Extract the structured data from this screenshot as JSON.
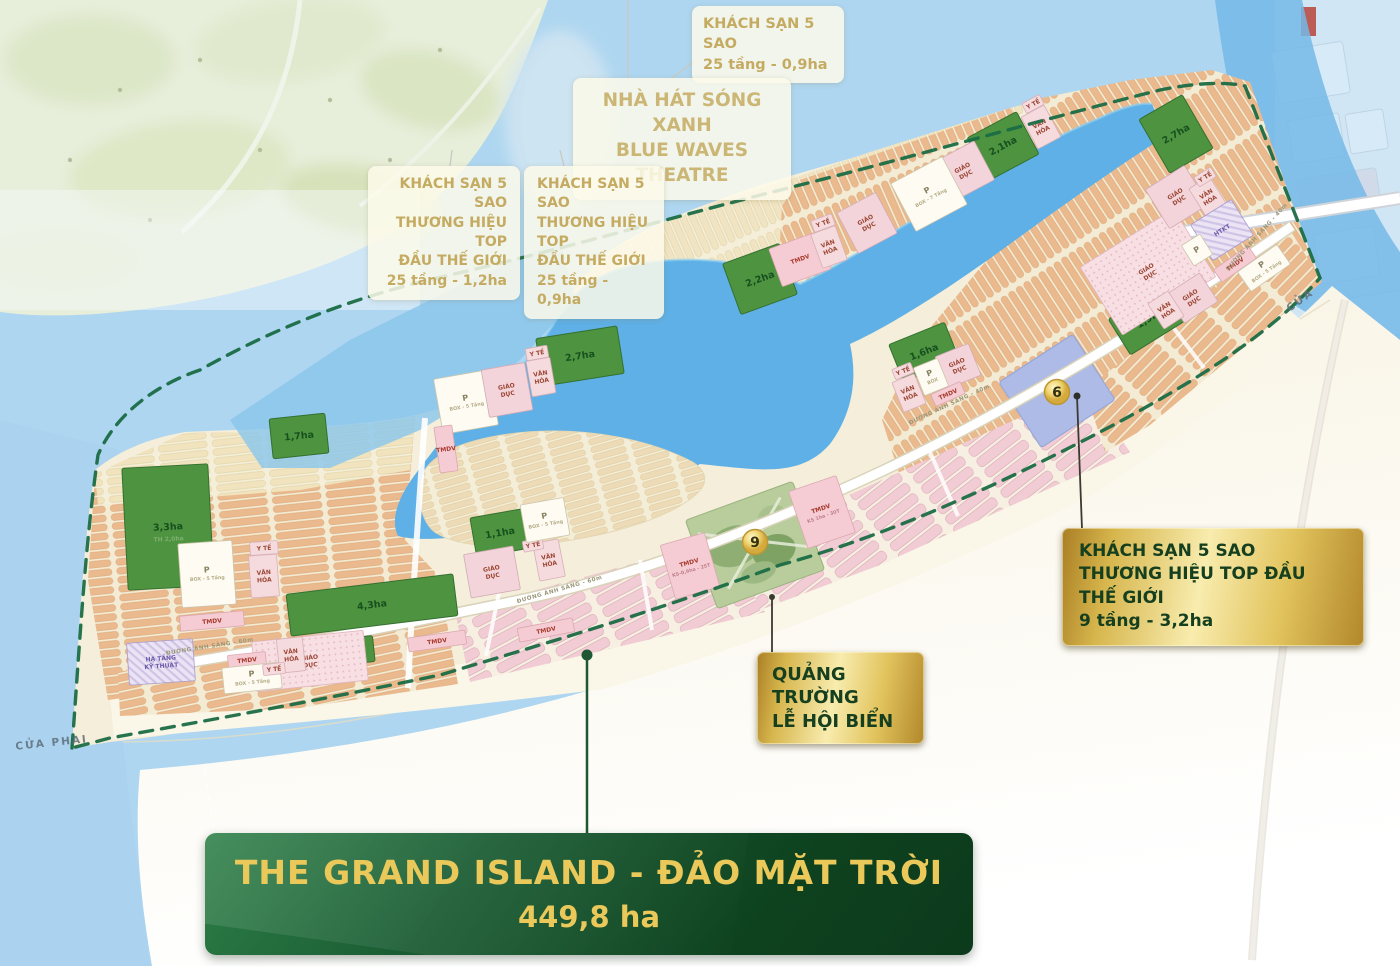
{
  "island": {
    "name_line1": "THE GRAND ISLAND - ĐẢO MẶT TRỜI",
    "area": "449,8 ha"
  },
  "callouts": {
    "hotel_top": {
      "lines": [
        "KHÁCH SẠN 5 SAO",
        "25 tầng - 0,9ha"
      ]
    },
    "theatre": {
      "lines": [
        "NHÀ HÁT SÓNG XANH",
        "BLUE WAVES THEATRE"
      ]
    },
    "hotel_left1": {
      "lines": [
        "KHÁCH SẠN 5 SAO",
        "THƯƠNG HIỆU TOP",
        "ĐẦU THẾ GIỚI",
        "25 tầng - 1,2ha"
      ]
    },
    "hotel_left2": {
      "lines": [
        "KHÁCH SẠN 5 SAO",
        "THƯƠNG HIỆU TOP",
        "ĐẦU THẾ GIỚI",
        "25 tầng - 0,9ha"
      ]
    },
    "hotel_right": {
      "lines": [
        "KHÁCH SẠN 5 SAO",
        "THƯƠNG HIỆU TOP ĐẦU THẾ GIỚI",
        "9 tầng - 3,2ha"
      ]
    },
    "plaza": {
      "lines": [
        "QUẢNG TRƯỜNG",
        "LỄ HỘI BIỂN"
      ]
    }
  },
  "map": {
    "parks": [
      {
        "t": "3,3ha",
        "sub": "TH 2,0ha",
        "x": 168,
        "y": 527,
        "w": 86,
        "h": 122,
        "r": -3
      },
      {
        "t": "1,7ha",
        "x": 299,
        "y": 436,
        "w": 56,
        "h": 40,
        "r": -6
      },
      {
        "t": "2,7ha",
        "x": 580,
        "y": 356,
        "w": 82,
        "h": 48,
        "r": -9
      },
      {
        "t": "2,2ha",
        "x": 760,
        "y": 279,
        "w": 60,
        "h": 54,
        "r": -20
      },
      {
        "t": "2,1ha",
        "x": 1003,
        "y": 146,
        "w": 56,
        "h": 48,
        "r": -28
      },
      {
        "t": "2,7ha",
        "x": 1176,
        "y": 134,
        "w": 50,
        "h": 62,
        "r": -30
      },
      {
        "t": "1,6ha",
        "x": 924,
        "y": 352,
        "w": 60,
        "h": 40,
        "r": -22
      },
      {
        "t": "1,9ha",
        "x": 1150,
        "y": 318,
        "w": 72,
        "h": 42,
        "r": -32
      },
      {
        "t": "1,1ha",
        "x": 500,
        "y": 533,
        "w": 54,
        "h": 40,
        "r": -10
      },
      {
        "t": "4,3ha",
        "x": 372,
        "y": 605,
        "w": 168,
        "h": 42,
        "r": -7
      },
      {
        "t": "1,3ha",
        "x": 331,
        "y": 653,
        "w": 86,
        "h": 26,
        "r": -6
      }
    ],
    "facilities": [
      {
        "l": [
          "P",
          "BOX - 5 Tầng"
        ],
        "t": "parking",
        "x": 207,
        "y": 574,
        "w": 54,
        "h": 64,
        "r": -4
      },
      {
        "l": [
          "VĂN",
          "HÓA"
        ],
        "t": "culture",
        "x": 264,
        "y": 576,
        "w": 28,
        "h": 42,
        "r": -4
      },
      {
        "l": [
          "Y TẾ"
        ],
        "t": "health",
        "x": 264,
        "y": 548,
        "w": 28,
        "h": 13,
        "r": -4
      },
      {
        "l": [
          "TMDV"
        ],
        "t": "tmdv",
        "x": 212,
        "y": 621,
        "w": 64,
        "h": 15,
        "r": -5
      },
      {
        "l": [
          "HẠ TẦNG",
          "KỸ THUẬT"
        ],
        "t": "htkt",
        "x": 161,
        "y": 662,
        "w": 66,
        "h": 42,
        "r": -4
      },
      {
        "l": [
          "GIÁO",
          "DỤC"
        ],
        "t": "zone",
        "x": 310,
        "y": 661,
        "w": 112,
        "h": 50,
        "r": -6
      },
      {
        "l": [
          "TMDV"
        ],
        "t": "tmdv",
        "x": 247,
        "y": 660,
        "w": 38,
        "h": 13,
        "r": -6
      },
      {
        "l": [
          "P",
          "BOX - 5 Tầng"
        ],
        "t": "parking",
        "x": 252,
        "y": 678,
        "w": 58,
        "h": 26,
        "r": -6
      },
      {
        "l": [
          "VĂN",
          "HÓA"
        ],
        "t": "culture",
        "x": 291,
        "y": 655,
        "w": 26,
        "h": 34,
        "r": -6
      },
      {
        "l": [
          "Y TẾ"
        ],
        "t": "health",
        "x": 274,
        "y": 669,
        "w": 22,
        "h": 11,
        "r": -6
      },
      {
        "l": [
          "TMDV"
        ],
        "t": "tmdv",
        "x": 437,
        "y": 641,
        "w": 58,
        "h": 14,
        "r": -8
      },
      {
        "l": [
          "GIÁO",
          "DỤC"
        ],
        "t": "edu",
        "x": 492,
        "y": 572,
        "w": 50,
        "h": 44,
        "r": -10
      },
      {
        "l": [
          "VĂN",
          "HÓA"
        ],
        "t": "culture",
        "x": 549,
        "y": 560,
        "w": 26,
        "h": 38,
        "r": -11
      },
      {
        "l": [
          "Y TẾ"
        ],
        "t": "health",
        "x": 533,
        "y": 545,
        "w": 20,
        "h": 11,
        "r": -11
      },
      {
        "l": [
          "TMDV"
        ],
        "t": "tmdv",
        "x": 546,
        "y": 630,
        "w": 56,
        "h": 14,
        "r": -11
      },
      {
        "l": [
          "P",
          "BOX - 5 Tầng"
        ],
        "t": "parking",
        "x": 466,
        "y": 402,
        "w": 56,
        "h": 56,
        "r": -10
      },
      {
        "l": [
          "GIÁO",
          "DỤC"
        ],
        "t": "edu",
        "x": 507,
        "y": 390,
        "w": 44,
        "h": 48,
        "r": -10
      },
      {
        "l": [
          "VĂN",
          "HÓA"
        ],
        "t": "culture",
        "x": 541,
        "y": 377,
        "w": 24,
        "h": 36,
        "r": -10
      },
      {
        "l": [
          "Y TẾ"
        ],
        "t": "health",
        "x": 537,
        "y": 353,
        "w": 22,
        "h": 12,
        "r": -10
      },
      {
        "l": [
          "TMDV"
        ],
        "t": "tmdv",
        "x": 446,
        "y": 449,
        "w": 18,
        "h": 46,
        "r": -8
      },
      {
        "l": [
          "P",
          "BOX - 5 Tầng"
        ],
        "t": "parking",
        "x": 545,
        "y": 520,
        "w": 44,
        "h": 38,
        "r": -10
      },
      {
        "l": [
          "TMDV"
        ],
        "t": "tmdv",
        "x": 800,
        "y": 259,
        "w": 52,
        "h": 40,
        "r": -20
      },
      {
        "l": [
          "VĂN",
          "HÓA"
        ],
        "t": "culture",
        "x": 829,
        "y": 247,
        "w": 26,
        "h": 36,
        "r": -20
      },
      {
        "l": [
          "Y TẾ"
        ],
        "t": "health",
        "x": 823,
        "y": 223,
        "w": 22,
        "h": 12,
        "r": -20
      },
      {
        "l": [
          "GIÁO",
          "DỤC"
        ],
        "t": "edu",
        "x": 958,
        "y": 366,
        "w": 36,
        "h": 34,
        "r": -22
      },
      {
        "l": [
          "P",
          "BOX"
        ],
        "t": "parking",
        "x": 931,
        "y": 377,
        "w": 26,
        "h": 30,
        "r": -22
      },
      {
        "l": [
          "VĂN",
          "HÓA"
        ],
        "t": "culture",
        "x": 909,
        "y": 393,
        "w": 24,
        "h": 32,
        "r": -22
      },
      {
        "l": [
          "Y TẾ"
        ],
        "t": "health",
        "x": 903,
        "y": 371,
        "w": 20,
        "h": 11,
        "r": -22
      },
      {
        "l": [
          "TMDV"
        ],
        "t": "tmdv",
        "x": 948,
        "y": 394,
        "w": 32,
        "h": 13,
        "r": -24
      },
      {
        "l": [
          "TMDV",
          "KS-0,9ha - 25T"
        ],
        "t": "ks",
        "x": 690,
        "y": 566,
        "w": 46,
        "h": 56,
        "r": -16
      },
      {
        "l": [
          "TMDV",
          "KS 1ha - 30T"
        ],
        "t": "ks",
        "x": 822,
        "y": 512,
        "w": 50,
        "h": 60,
        "r": -19
      },
      {
        "l": [
          "VĂN",
          "HÓA"
        ],
        "t": "culture",
        "x": 1041,
        "y": 127,
        "w": 26,
        "h": 36,
        "r": -28
      },
      {
        "l": [
          "Y TẾ"
        ],
        "t": "health",
        "x": 1033,
        "y": 104,
        "w": 20,
        "h": 11,
        "r": -28
      },
      {
        "l": [
          "GIÁO",
          "DỤC"
        ],
        "t": "edu",
        "x": 964,
        "y": 171,
        "w": 46,
        "h": 44,
        "r": -28
      },
      {
        "l": [
          "P",
          "BOX - 7 Tầng"
        ],
        "t": "parking",
        "x": 929,
        "y": 194,
        "w": 58,
        "h": 54,
        "r": -28
      },
      {
        "l": [
          "GIÁO",
          "DỤC"
        ],
        "t": "edu",
        "x": 867,
        "y": 223,
        "w": 44,
        "h": 46,
        "r": -28
      },
      {
        "l": [
          "GIÁO",
          "DỤC"
        ],
        "t": "zone",
        "x": 1148,
        "y": 272,
        "w": 110,
        "h": 80,
        "r": -32
      },
      {
        "l": [
          "GIÁO",
          "DỤC"
        ],
        "t": "edu",
        "x": 1177,
        "y": 197,
        "w": 46,
        "h": 46,
        "r": -32
      },
      {
        "l": [
          "VĂN",
          "HÓA"
        ],
        "t": "culture",
        "x": 1208,
        "y": 197,
        "w": 24,
        "h": 34,
        "r": -32
      },
      {
        "l": [
          "Y TẾ"
        ],
        "t": "health",
        "x": 1205,
        "y": 177,
        "w": 20,
        "h": 11,
        "r": -32
      },
      {
        "l": [
          "HTKT"
        ],
        "t": "htkt",
        "x": 1222,
        "y": 230,
        "w": 48,
        "h": 42,
        "r": -32
      },
      {
        "l": [
          "P"
        ],
        "t": "parking",
        "x": 1197,
        "y": 250,
        "w": 22,
        "h": 24,
        "r": -32
      },
      {
        "l": [
          "TMDV"
        ],
        "t": "tmdv",
        "x": 1235,
        "y": 264,
        "w": 42,
        "h": 15,
        "r": -35
      },
      {
        "l": [
          "P",
          "BOX - 5 Tầng"
        ],
        "t": "parking",
        "x": 1264,
        "y": 268,
        "w": 48,
        "h": 24,
        "r": -35
      },
      {
        "l": [
          "GIÁO",
          "DỤC"
        ],
        "t": "edu",
        "x": 1192,
        "y": 298,
        "w": 40,
        "h": 34,
        "r": -33
      },
      {
        "l": [
          "VĂN",
          "HÓA"
        ],
        "t": "culture",
        "x": 1166,
        "y": 310,
        "w": 24,
        "h": 30,
        "r": -33
      }
    ],
    "roads": [
      {
        "t": "ĐƯỜNG ÁNH SÁNG - 60m",
        "x": 210,
        "y": 648,
        "r": -9
      },
      {
        "t": "ĐƯỜNG ÁNH SÁNG - 60m",
        "x": 560,
        "y": 591,
        "r": -16
      },
      {
        "t": "ĐƯỜNG ÁNH SÁNG - 40m",
        "x": 950,
        "y": 406,
        "r": -25
      },
      {
        "t": "ĐƯỜNG ÁNH SÁNG - 40m",
        "x": 1258,
        "y": 238,
        "r": -48
      }
    ],
    "water_labels": [
      {
        "t": "CỬA PHAI",
        "x": 52,
        "y": 746,
        "r": -6
      },
      {
        "t": "CỬA",
        "x": 1302,
        "y": 303,
        "r": -36
      }
    ],
    "markers": [
      {
        "t": "6",
        "x": 1057,
        "y": 392
      },
      {
        "t": "9",
        "x": 755,
        "y": 542
      }
    ]
  },
  "colors": {
    "sea": "#aed6f0",
    "lagoon": "#5fb0e6",
    "sand": "#f4eeda",
    "park_green": "#4e9340",
    "boundary_green": "#1a6b45",
    "gold_text": "#eac85a",
    "plaque_gold": "#e2c45e",
    "title_green": "#14532c"
  }
}
